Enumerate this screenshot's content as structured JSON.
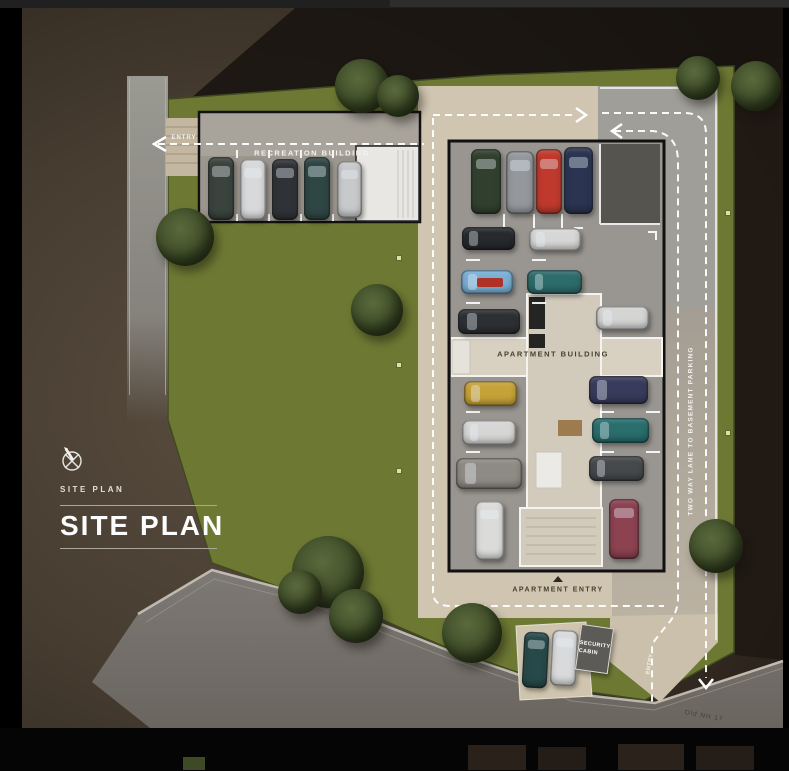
{
  "panel": {
    "eyebrow": "SITE PLAN",
    "title": "SITE PLAN"
  },
  "labels": {
    "entry_top": "ENTRY",
    "recreation_building": "RECREATION BUILDING",
    "apartment_building": "APARTMENT BUILDING",
    "apartment_entry": "APARTMENT ENTRY",
    "security_cabin": "SECURITY CABIN",
    "two_way_lane": "TWO WAY LANE TO BASEMENT PARKING",
    "entry_bottom": "ENTRY",
    "road_name": "Old NH 17"
  },
  "colors": {
    "lawn": "#6d7933",
    "paving": "#cfc5b1",
    "asphalt": "#8b8b89",
    "outline": "#111111",
    "path": "#ffffff",
    "panel_text": "#fdfdfd",
    "background": "#473d31"
  },
  "site": {
    "cars": [
      {
        "x": 208,
        "y": 157,
        "w": 26,
        "h": 63,
        "color": "#3a433d"
      },
      {
        "x": 240,
        "y": 159,
        "w": 26,
        "h": 61,
        "color": "#d8d9da"
      },
      {
        "x": 272,
        "y": 159,
        "w": 26,
        "h": 61,
        "color": "#2f3337"
      },
      {
        "x": 304,
        "y": 157,
        "w": 26,
        "h": 63,
        "color": "#2e4644"
      },
      {
        "x": 337,
        "y": 161,
        "w": 25,
        "h": 57,
        "color": "#c7c9cb"
      },
      {
        "x": 471,
        "y": 149,
        "w": 30,
        "h": 65,
        "color": "#31402e"
      },
      {
        "x": 506,
        "y": 151,
        "w": 28,
        "h": 63,
        "color": "#94979c"
      },
      {
        "x": 536,
        "y": 149,
        "w": 26,
        "h": 65,
        "color": "#bf3a2d"
      },
      {
        "x": 564,
        "y": 147,
        "w": 29,
        "h": 67,
        "color": "#2b3450"
      },
      {
        "x": 462,
        "y": 227,
        "w": 53,
        "h": 23,
        "color": "#26292d"
      },
      {
        "x": 461,
        "y": 270,
        "w": 52,
        "h": 24,
        "color": "#79b0d6",
        "accent": "#b03227"
      },
      {
        "x": 458,
        "y": 309,
        "w": 62,
        "h": 25,
        "color": "#2c2f33"
      },
      {
        "x": 464,
        "y": 381,
        "w": 53,
        "h": 25,
        "color": "#c7a238"
      },
      {
        "x": 462,
        "y": 420,
        "w": 54,
        "h": 25,
        "color": "#d6d6d5"
      },
      {
        "x": 456,
        "y": 458,
        "w": 66,
        "h": 31,
        "color": "#8e8b85"
      },
      {
        "x": 475,
        "y": 501,
        "w": 29,
        "h": 59,
        "color": "#dbdbda"
      },
      {
        "x": 529,
        "y": 228,
        "w": 52,
        "h": 23,
        "color": "#d7d7d6"
      },
      {
        "x": 527,
        "y": 270,
        "w": 55,
        "h": 24,
        "color": "#2d6c6b"
      },
      {
        "x": 596,
        "y": 306,
        "w": 53,
        "h": 24,
        "color": "#d4d4d3"
      },
      {
        "x": 589,
        "y": 376,
        "w": 59,
        "h": 28,
        "color": "#383c5c"
      },
      {
        "x": 592,
        "y": 418,
        "w": 57,
        "h": 25,
        "color": "#296e6d"
      },
      {
        "x": 589,
        "y": 456,
        "w": 55,
        "h": 25,
        "color": "#46494c"
      },
      {
        "x": 609,
        "y": 499,
        "w": 30,
        "h": 60,
        "color": "#8c4251"
      },
      {
        "x": 523,
        "y": 632,
        "w": 25,
        "h": 56,
        "color": "#27494a",
        "rot": 3
      },
      {
        "x": 551,
        "y": 630,
        "w": 26,
        "h": 56,
        "color": "#d9dadb",
        "rot": 3
      }
    ],
    "trees": [
      {
        "cx": 362,
        "cy": 86,
        "r": 27
      },
      {
        "cx": 398,
        "cy": 96,
        "r": 21
      },
      {
        "cx": 185,
        "cy": 237,
        "r": 29
      },
      {
        "cx": 377,
        "cy": 310,
        "r": 26
      },
      {
        "cx": 328,
        "cy": 572,
        "r": 36
      },
      {
        "cx": 300,
        "cy": 592,
        "r": 22
      },
      {
        "cx": 356,
        "cy": 616,
        "r": 27
      },
      {
        "cx": 472,
        "cy": 633,
        "r": 30
      },
      {
        "cx": 716,
        "cy": 546,
        "r": 27
      },
      {
        "cx": 698,
        "cy": 78,
        "r": 22
      },
      {
        "cx": 756,
        "cy": 86,
        "r": 25
      }
    ],
    "lamps": [
      {
        "x": 396,
        "y": 255
      },
      {
        "x": 396,
        "y": 362
      },
      {
        "x": 396,
        "y": 468
      },
      {
        "x": 725,
        "y": 210
      },
      {
        "x": 725,
        "y": 430
      }
    ]
  }
}
